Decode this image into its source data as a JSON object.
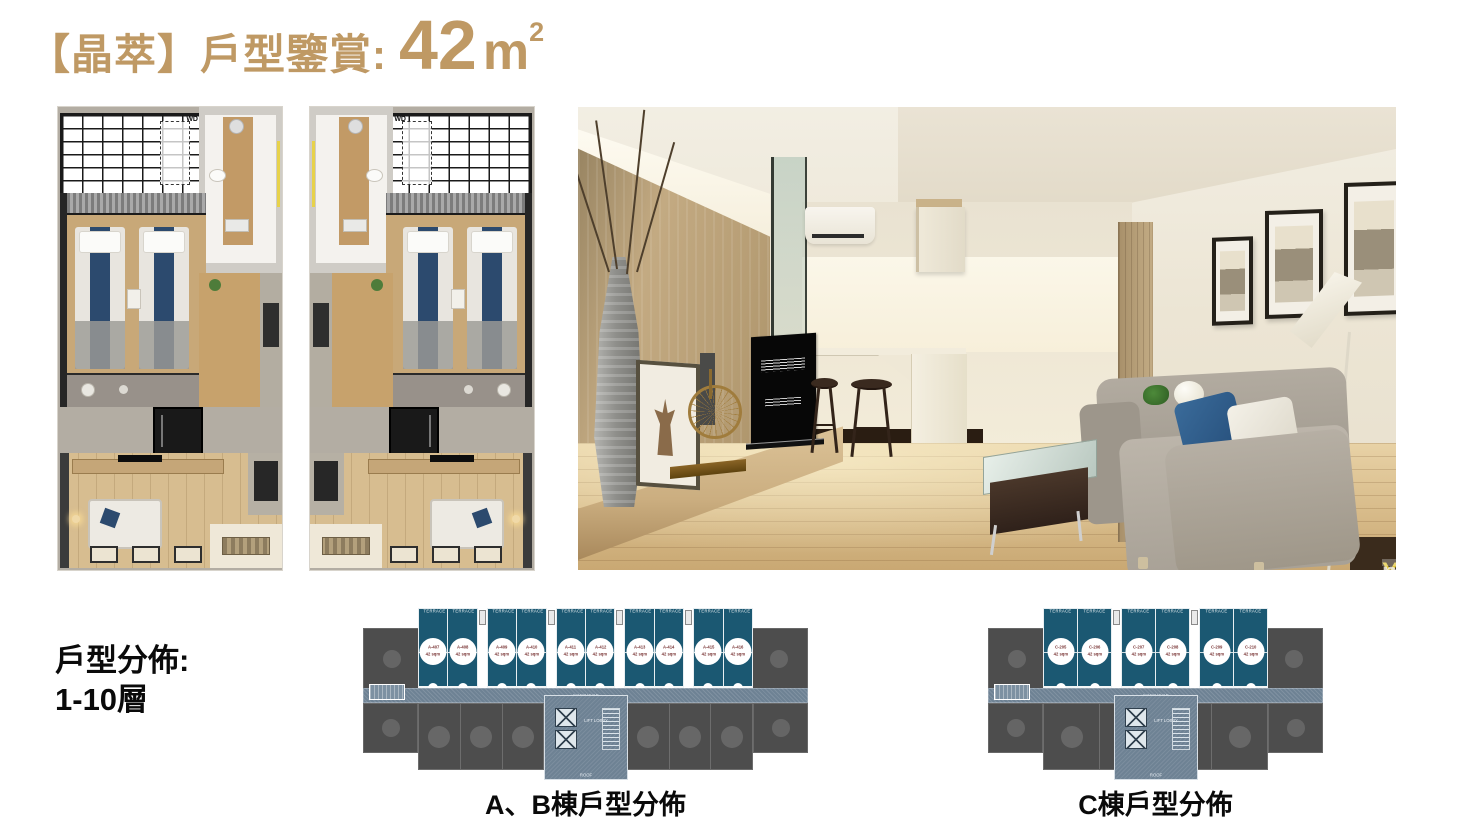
{
  "title": {
    "text": "【晶萃】戶型鑒賞:",
    "area_value": "42",
    "area_unit": "m",
    "area_exponent": "2"
  },
  "left_note": {
    "line1": "戶型分佈:",
    "line2": "1-10層"
  },
  "floorplan": {
    "wd_label": "WD"
  },
  "render": {
    "watermark_part1": "You",
    "watermark_part2": "nique"
  },
  "diagrams": {
    "ab": {
      "caption": "A、B棟戶型分佈",
      "labels": {
        "terrace": "TERRACE",
        "corridor": "CORRIDOR",
        "lift": "LIFT LOBBY",
        "roof": "ROOF"
      },
      "dim_units": 8,
      "units": [
        {
          "id": "A-407",
          "area": "42 sqm"
        },
        {
          "id": "A-408",
          "area": "42 sqm"
        },
        {
          "id": "A-409",
          "area": "42 sqm"
        },
        {
          "id": "A-410",
          "area": "42 sqm"
        },
        {
          "id": "A-411",
          "area": "42 sqm"
        },
        {
          "id": "A-412",
          "area": "42 sqm"
        },
        {
          "id": "A-413",
          "area": "42 sqm"
        },
        {
          "id": "A-414",
          "area": "42 sqm"
        },
        {
          "id": "A-415",
          "area": "42 sqm"
        },
        {
          "id": "A-416",
          "area": "42 sqm"
        }
      ]
    },
    "c": {
      "caption": "C棟戶型分佈",
      "labels": {
        "terrace": "TERRACE",
        "corridor": "CORRIDOR",
        "lift": "LIFT LOBBY",
        "roof": "ROOF"
      },
      "dim_units": 4,
      "units": [
        {
          "id": "C-205",
          "area": "42 sqm"
        },
        {
          "id": "C-206",
          "area": "42 sqm"
        },
        {
          "id": "C-207",
          "area": "42 sqm"
        },
        {
          "id": "C-208",
          "area": "42 sqm"
        },
        {
          "id": "C-209",
          "area": "42 sqm"
        },
        {
          "id": "C-210",
          "area": "42 sqm"
        }
      ]
    }
  },
  "colors": {
    "accent_gold": "#BF9964",
    "unit_teal": "#1B5872",
    "unit_gray": "#4D4D4D",
    "corridor_blue": "#6E8294",
    "highlight_circle": "#FFFFFF",
    "circle_text": "#7A3636",
    "watermark_yellow": "#E2C73B"
  }
}
